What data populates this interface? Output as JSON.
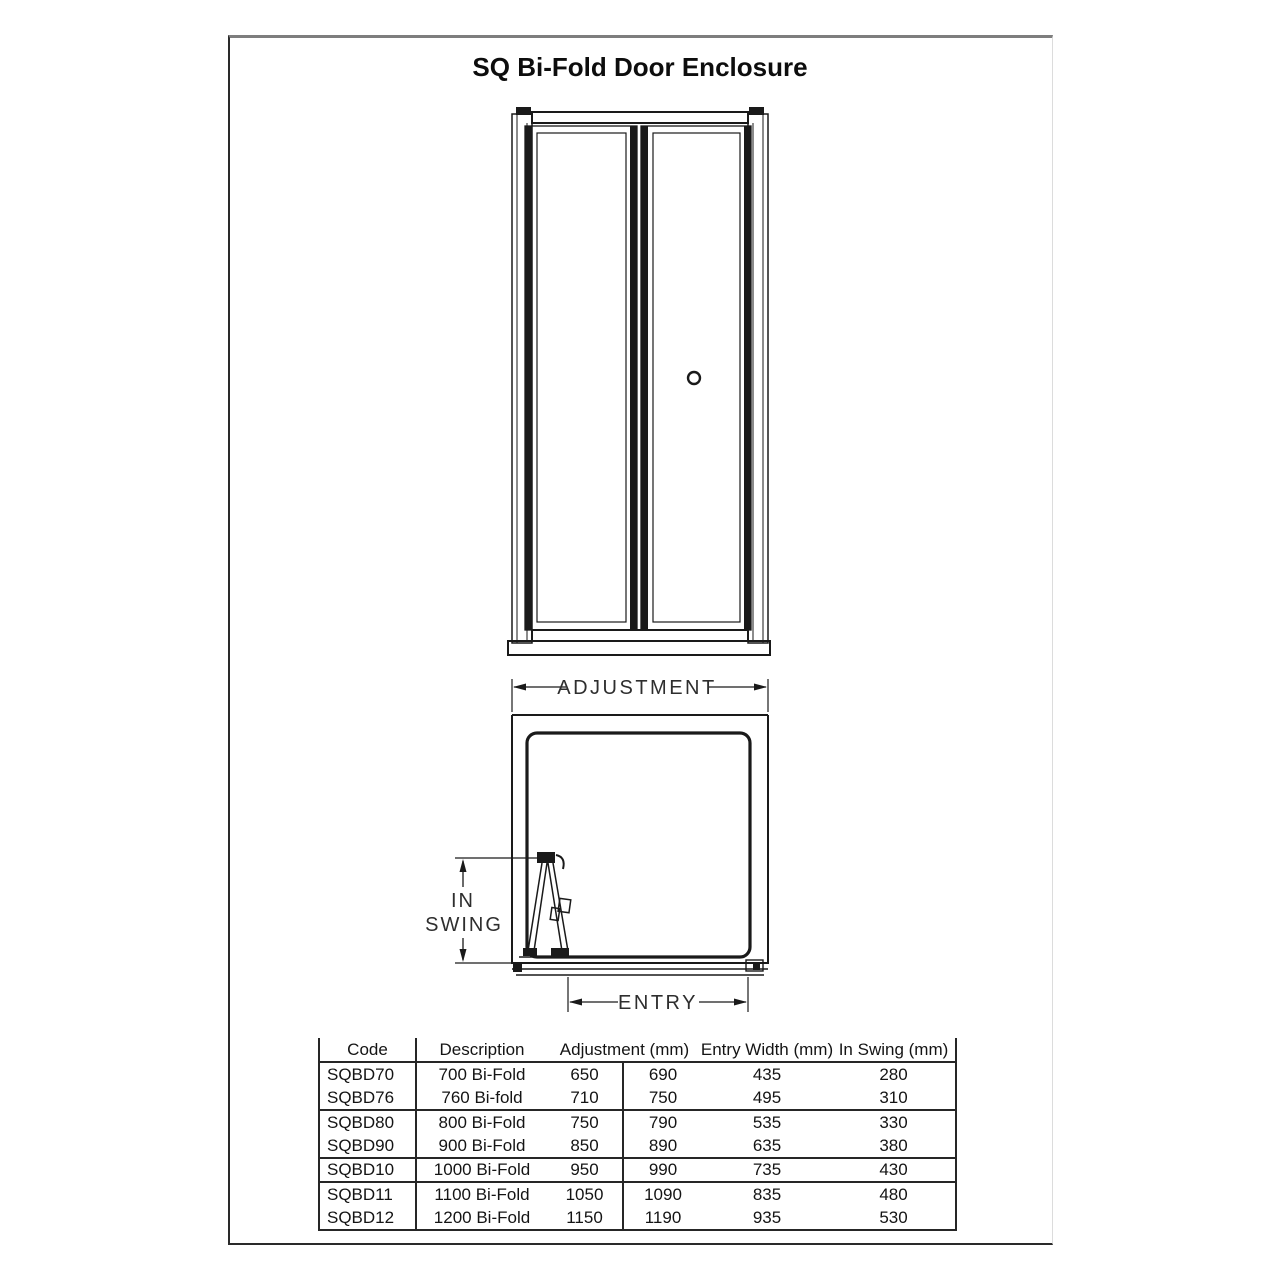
{
  "page": {
    "title": "SQ Bi-Fold Door Enclosure"
  },
  "diagram": {
    "labels": {
      "adjustment": "ADJUSTMENT",
      "in_swing_line1": "IN",
      "in_swing_line2": "SWING",
      "entry": "ENTRY"
    },
    "colors": {
      "line": "#1a1a1a",
      "dim_text": "#2e2e2e"
    }
  },
  "table": {
    "headers": {
      "code": "Code",
      "description": "Description",
      "adjustment": "Adjustment (mm)",
      "entry_width": "Entry Width (mm)",
      "in_swing": "In Swing (mm)"
    },
    "rows": [
      {
        "code": "SQBD70",
        "description": "700 Bi-Fold",
        "adjustment_min": "650",
        "adjustment_max": "690",
        "entry_width": "435",
        "in_swing": "280"
      },
      {
        "code": "SQBD76",
        "description": "760 Bi-fold",
        "adjustment_min": "710",
        "adjustment_max": "750",
        "entry_width": "495",
        "in_swing": "310"
      },
      {
        "code": "SQBD80",
        "description": "800 Bi-Fold",
        "adjustment_min": "750",
        "adjustment_max": "790",
        "entry_width": "535",
        "in_swing": "330"
      },
      {
        "code": "SQBD90",
        "description": "900 Bi-Fold",
        "adjustment_min": "850",
        "adjustment_max": "890",
        "entry_width": "635",
        "in_swing": "380"
      },
      {
        "code": "SQBD10",
        "description": "1000 Bi-Fold",
        "adjustment_min": "950",
        "adjustment_max": "990",
        "entry_width": "735",
        "in_swing": "430"
      },
      {
        "code": "SQBD11",
        "description": "1100 Bi-Fold",
        "adjustment_min": "1050",
        "adjustment_max": "1090",
        "entry_width": "835",
        "in_swing": "480"
      },
      {
        "code": "SQBD12",
        "description": "1200 Bi-Fold",
        "adjustment_min": "1150",
        "adjustment_max": "1190",
        "entry_width": "935",
        "in_swing": "530"
      }
    ]
  }
}
